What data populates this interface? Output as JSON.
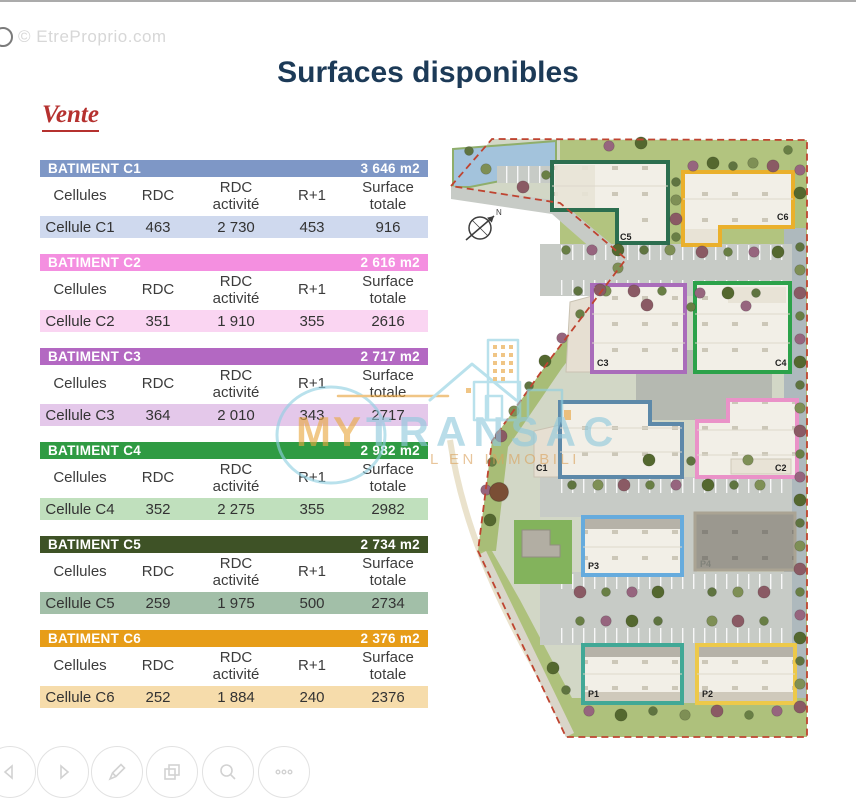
{
  "page": {
    "watermark": "© EtreProprio.com",
    "title": "Surfaces disponibles",
    "section": "Vente"
  },
  "table": {
    "columns": [
      "Cellules",
      "RDC",
      "RDC activité",
      "R+1",
      "Surface totale"
    ]
  },
  "buildings": [
    {
      "name": "BATIMENT C1",
      "total": "3 646 m2",
      "row": [
        "Cellule C1",
        "463",
        "2 730",
        "453",
        "916"
      ],
      "header_color": "#7e97c6",
      "row_color": "#cfd9ee"
    },
    {
      "name": "BATIMENT C2",
      "total": "2 616 m2",
      "row": [
        "Cellule C2",
        "351",
        "1 910",
        "355",
        "2616"
      ],
      "header_color": "#f48fe0",
      "row_color": "#fad5f2"
    },
    {
      "name": "BATIMENT C3",
      "total": "2 717 m2",
      "row": [
        "Cellule C3",
        "364",
        "2 010",
        "343",
        "2717"
      ],
      "header_color": "#b368c2",
      "row_color": "#e4c8ea"
    },
    {
      "name": "BATIMENT C4",
      "total": "2 982 m2",
      "row": [
        "Cellule C4",
        "352",
        "2 275",
        "355",
        "2982"
      ],
      "header_color": "#2f9b43",
      "row_color": "#c0e0bd"
    },
    {
      "name": "BATIMENT C5",
      "total": "2 734 m2",
      "row": [
        "Cellule C5",
        "259",
        "1 975",
        "500",
        "2734"
      ],
      "header_color": "#3e5226",
      "row_color": "#a2bfa8"
    },
    {
      "name": "BATIMENT C6",
      "total": "2 376 m2",
      "row": [
        "Cellule C6",
        "252",
        "1 884",
        "240",
        "2376"
      ],
      "header_color": "#e79d18",
      "row_color": "#f6dcab"
    }
  ],
  "brand": {
    "word1": "MY",
    "word2": "TRANSAC",
    "tagline": "L EN IMMOBILI",
    "orange": "#e8a23c",
    "blue": "#8fc9dd"
  },
  "map": {
    "compass": "N",
    "labels": {
      "c1": "C1",
      "c2": "C2",
      "c3": "C3",
      "c4": "C4",
      "c5": "C5",
      "c6": "C6",
      "p1": "P1",
      "p2": "P2",
      "p3": "P3",
      "p4": "P4"
    },
    "outline_colors": {
      "c1": "#5d89a9",
      "c2": "#ea92c8",
      "c3": "#a96cba",
      "c4": "#2ca24a",
      "c5": "#2c6e4f",
      "c6": "#eab02c",
      "p1": "#41a896",
      "p2": "#edc94a",
      "p3": "#66abdd",
      "p4": "#aaa393"
    },
    "boundary_color": "#bf4430"
  },
  "toolbar": {
    "buttons": [
      "previous",
      "next",
      "draw",
      "gallery",
      "zoom",
      "more"
    ]
  }
}
